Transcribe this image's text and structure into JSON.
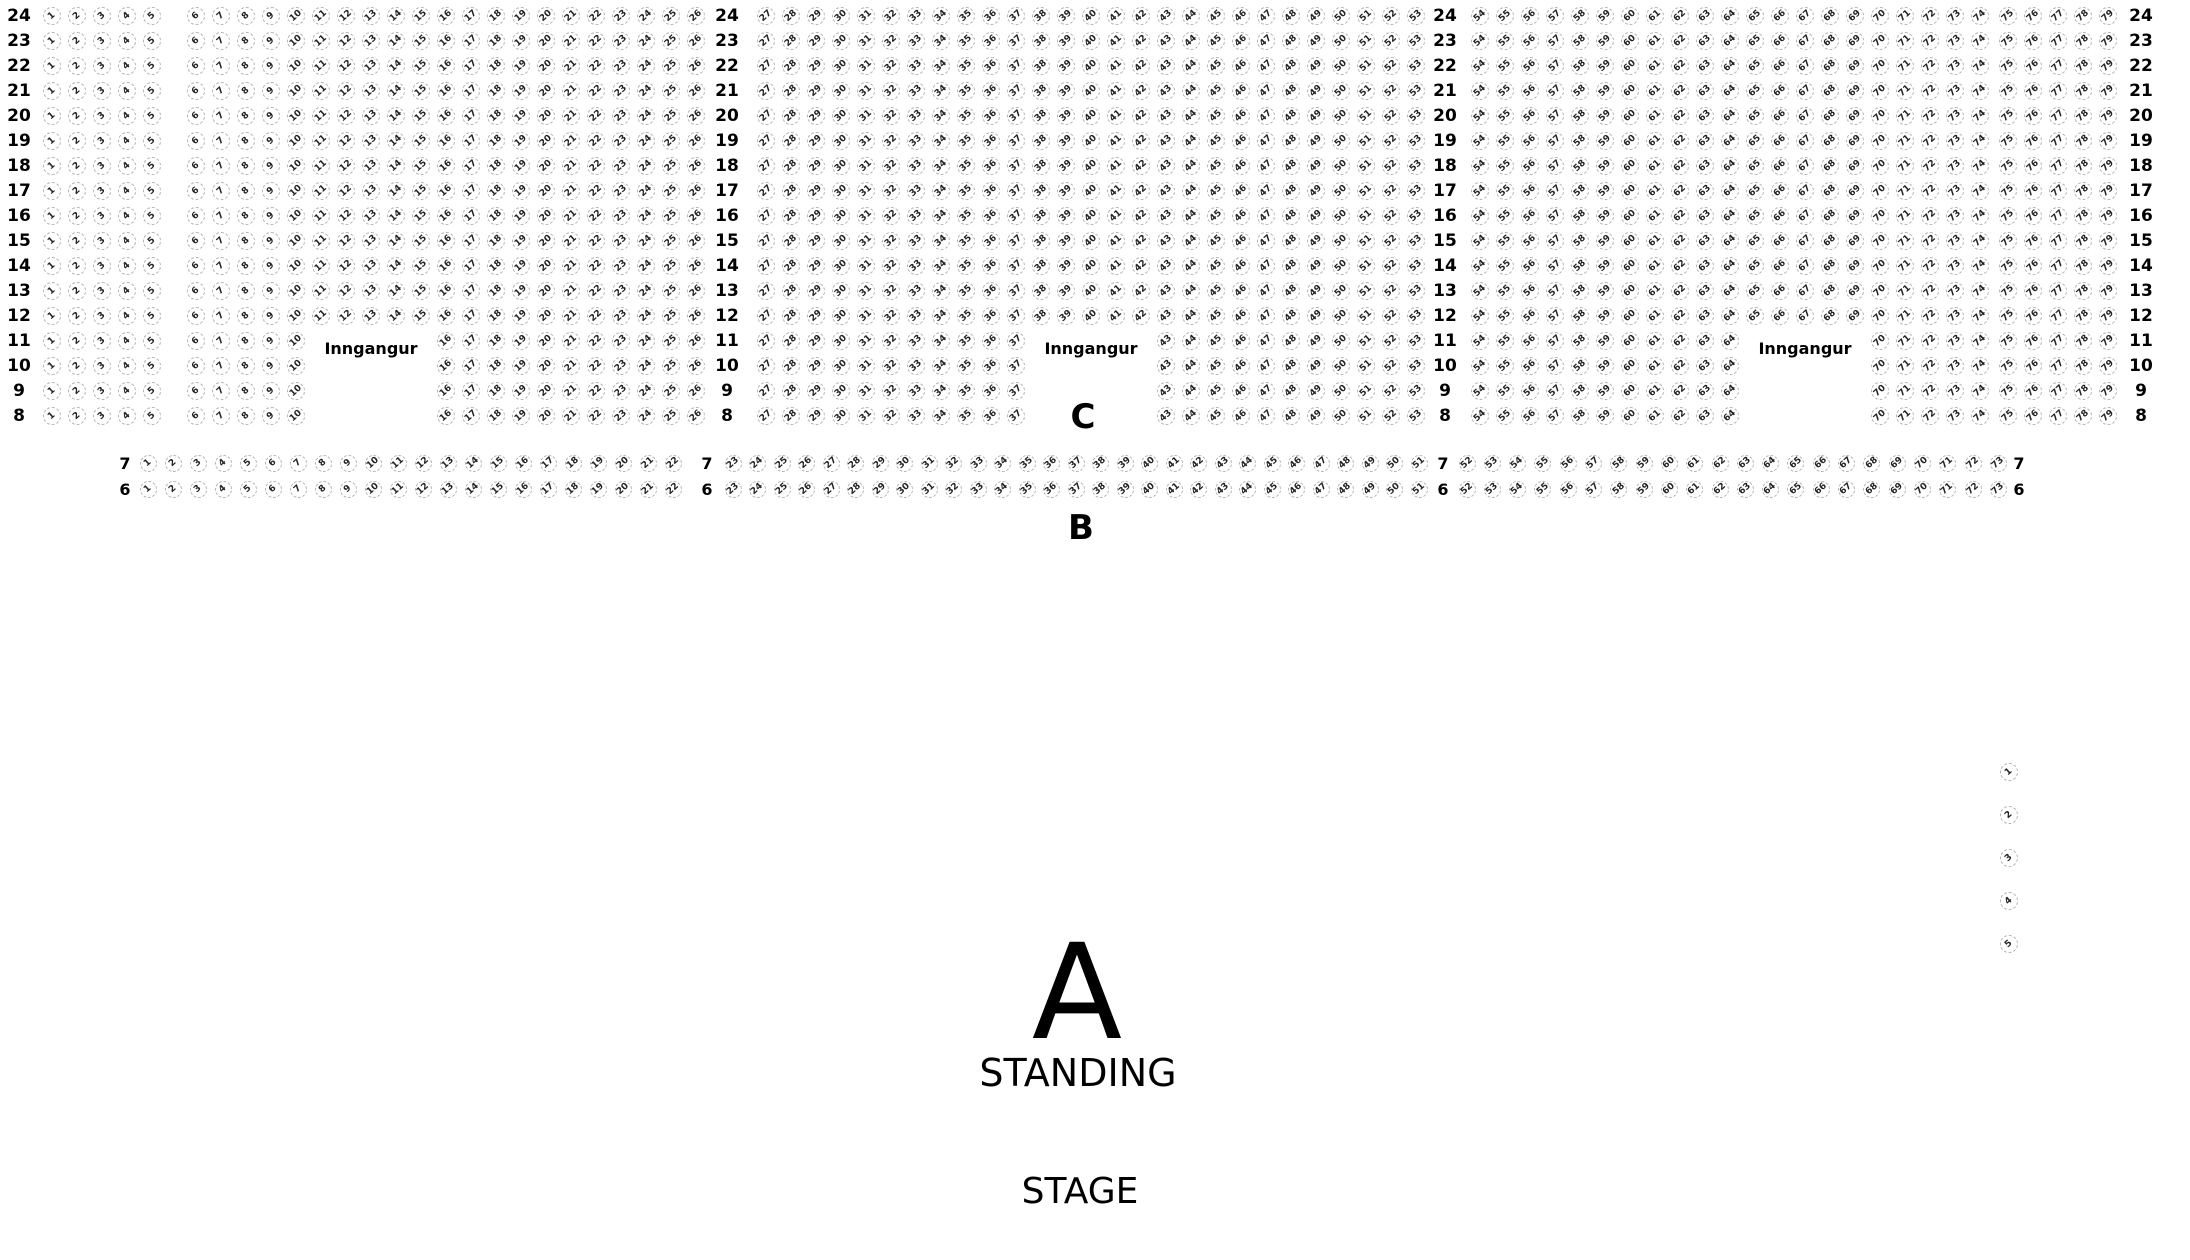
{
  "seat_map": {
    "colors": {
      "seat_border": "#b4b4b4",
      "seat_text": "#222222",
      "label_text": "#000000",
      "background": "#ffffff"
    },
    "top_section": {
      "section_name": "C",
      "rows": [
        24,
        23,
        22,
        21,
        20,
        19,
        18,
        17,
        16,
        15,
        14,
        13,
        12,
        11,
        10,
        9,
        8
      ],
      "row_y_top": 7,
      "row_pitch": 25,
      "seat_size": 18,
      "segments": [
        {
          "kind": "label",
          "left": 2,
          "width": 34
        },
        {
          "kind": "seats",
          "from": 1,
          "to": 5,
          "cx0": 52,
          "pitch": 25
        },
        {
          "kind": "seats",
          "from": 6,
          "to": 26,
          "cx0": 196,
          "pitch": 25
        },
        {
          "kind": "label",
          "left": 710,
          "width": 34
        },
        {
          "kind": "seats",
          "from": 27,
          "to": 53,
          "cx0": 766,
          "pitch": 25
        },
        {
          "kind": "label",
          "left": 1428,
          "width": 34
        },
        {
          "kind": "seats",
          "from": 54,
          "to": 74,
          "cx0": 1480,
          "pitch": 25
        },
        {
          "kind": "seats",
          "from": 75,
          "to": 79,
          "cx0": 2008,
          "pitch": 25
        },
        {
          "kind": "label",
          "left": 2123,
          "width": 36
        }
      ],
      "entrance_rows": [
        11,
        10,
        9,
        8
      ],
      "entrance_gaps": [
        [
          11,
          15
        ],
        [
          38,
          42
        ],
        [
          65,
          69
        ]
      ],
      "entrances": [
        {
          "label": "Inngangur",
          "cx": 371,
          "cy": 349
        },
        {
          "label": "Inngangur",
          "cx": 1091,
          "cy": 349
        },
        {
          "label": "Inngangur",
          "cx": 1805,
          "cy": 349
        }
      ]
    },
    "mid_section": {
      "section_name": "B",
      "rows": [
        {
          "num": 7,
          "y_top": 455
        },
        {
          "num": 6,
          "y_top": 481
        }
      ],
      "seat_size": 17,
      "segments": [
        {
          "kind": "label",
          "left": 112,
          "width": 26
        },
        {
          "kind": "seats",
          "from": 1,
          "to": 22,
          "cx0": 148,
          "pitch": 25
        },
        {
          "kind": "label",
          "left": 694,
          "width": 26
        },
        {
          "kind": "seats",
          "from": 23,
          "to": 51,
          "cx0": 733,
          "pitch": 24.5
        },
        {
          "kind": "label",
          "left": 1430,
          "width": 26
        },
        {
          "kind": "seats",
          "from": 52,
          "to": 73,
          "cx0": 1467,
          "pitch": 25.3
        },
        {
          "kind": "label",
          "left": 2006,
          "width": 26
        }
      ]
    },
    "side_section": {
      "seats": [
        1,
        2,
        3,
        4,
        5
      ],
      "cx": 2009,
      "cy0": 772,
      "pitch": 43,
      "seat_size": 18
    },
    "section_labels": [
      {
        "id": "c",
        "text": "C",
        "cx": 1083,
        "cy": 417,
        "size": 34,
        "bold": true
      },
      {
        "id": "b",
        "text": "B",
        "cx": 1081,
        "cy": 528,
        "size": 34,
        "bold": true
      },
      {
        "id": "a",
        "text": "A",
        "cx": 1077,
        "cy": 993,
        "size": 132,
        "bold": false
      },
      {
        "id": "standing",
        "text": "STANDING",
        "cx": 1078,
        "cy": 1073,
        "size": 38,
        "bold": false
      },
      {
        "id": "stage",
        "text": "STAGE",
        "cx": 1080,
        "cy": 1192,
        "size": 36,
        "bold": false
      }
    ]
  }
}
